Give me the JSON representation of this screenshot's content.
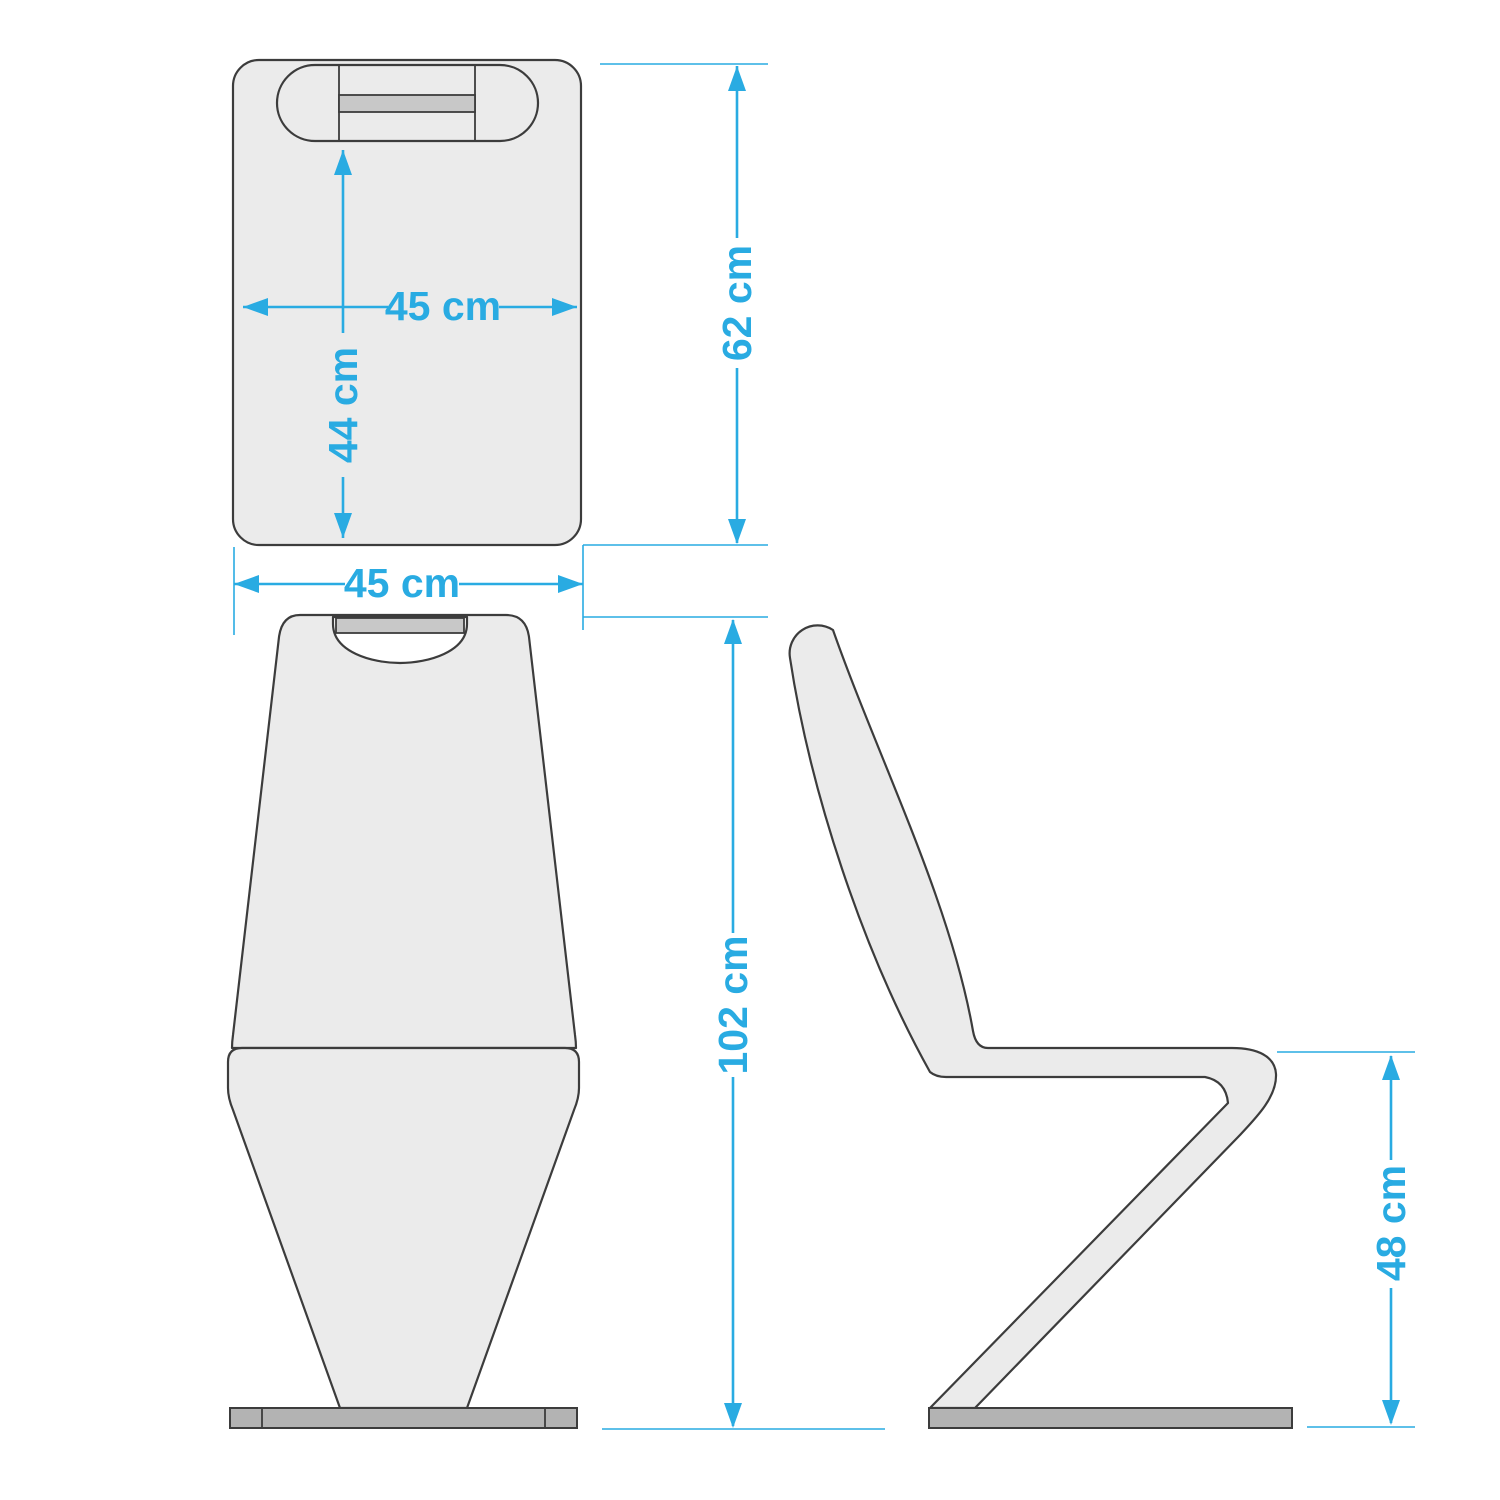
{
  "dimensions": {
    "seat_width": {
      "value": 45,
      "unit": "cm",
      "label": "45 cm"
    },
    "seat_depth": {
      "value": 44,
      "unit": "cm",
      "label": "44 cm"
    },
    "backrest_height": {
      "value": 62,
      "unit": "cm",
      "label": "62 cm"
    },
    "overall_width": {
      "value": 45,
      "unit": "cm",
      "label": "45 cm"
    },
    "overall_height": {
      "value": 102,
      "unit": "cm",
      "label": "102 cm"
    },
    "seat_height": {
      "value": 48,
      "unit": "cm",
      "label": "48 cm"
    }
  },
  "colors": {
    "accent": "#29ABE2",
    "outline": "#3C3C3C",
    "body_fill": "#EBEBEB",
    "handle_fill": "#C8C8C8",
    "base_fill": "#B3B3B3",
    "background": "#FFFFFF"
  }
}
